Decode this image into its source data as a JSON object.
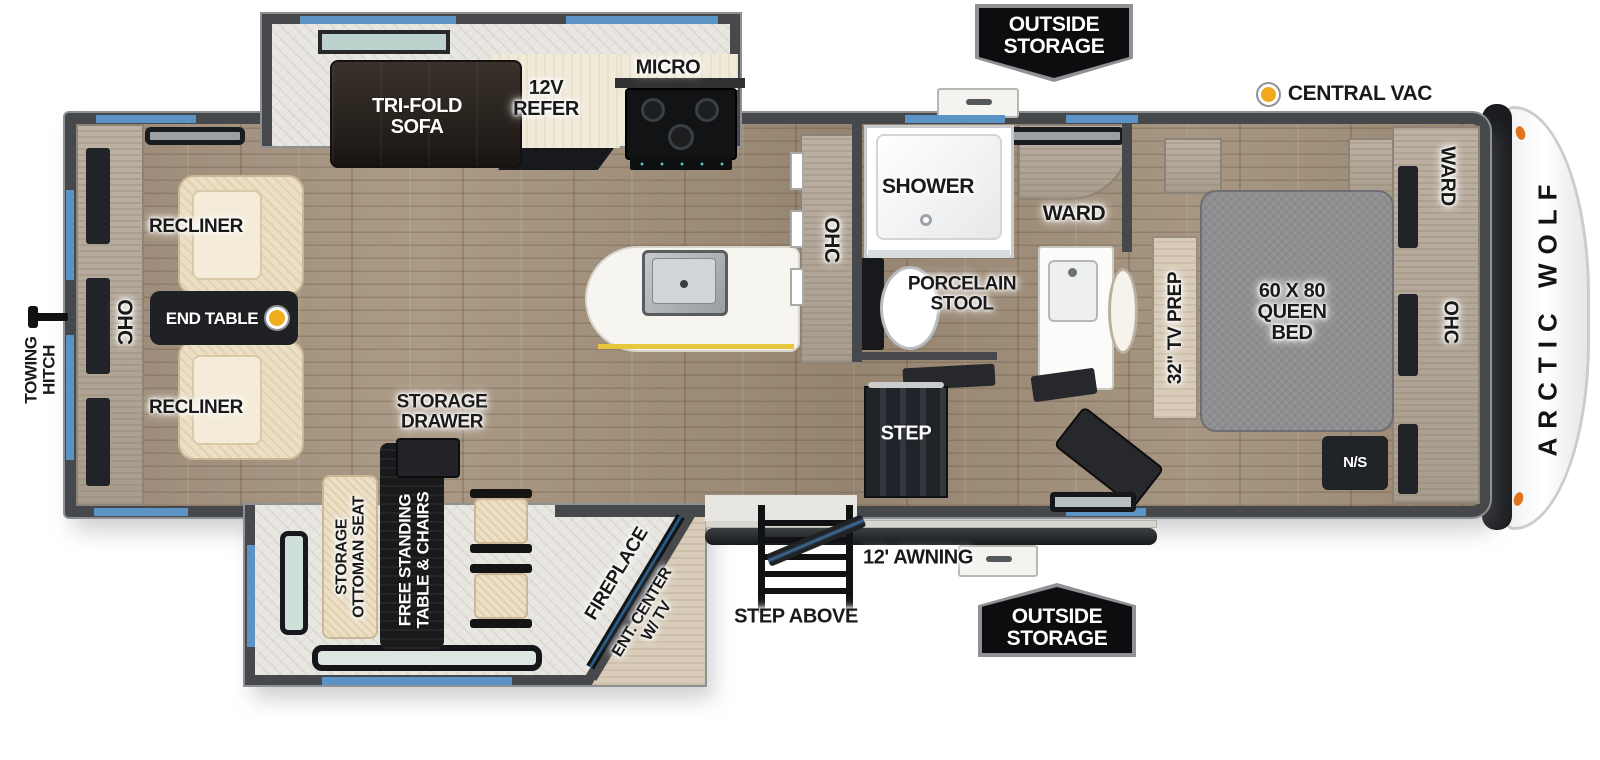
{
  "brand": "ARCTIC WOLF",
  "colors": {
    "accent_blue": "#5b93c4",
    "accent_yellow": "#f0ad1e",
    "accent_orange": "#e0731f",
    "wall": "#46484c",
    "badge_bg": "#0c0d0e"
  },
  "exterior": {
    "outside_storage_top": "OUTSIDE\nSTORAGE",
    "outside_storage_bottom": "OUTSIDE\nSTORAGE",
    "central_vac": "CENTRAL VAC",
    "awning": "12' AWNING",
    "step_above": "STEP ABOVE",
    "towing_hitch": "TOWING\nHITCH"
  },
  "living": {
    "ohc_rear": "OHC",
    "recliner_top": "RECLINER",
    "recliner_bottom": "RECLINER",
    "end_table": "END TABLE",
    "sofa": "TRI-FOLD\nSOFA"
  },
  "kitchen": {
    "refer": "12V\nREFER",
    "micro": "MICRO",
    "ohc_pantry": "OHC"
  },
  "dining": {
    "storage_drawer": "STORAGE\nDRAWER",
    "ottoman": "STORAGE\nOTTOMAN SEAT",
    "table": "FREE STANDING\nTABLE & CHAIRS",
    "fireplace": "FIREPLACE",
    "ent_center": "ENT. CENTER\nW/ TV"
  },
  "bath": {
    "shower": "SHOWER",
    "stool": "PORCELAIN\nSTOOL",
    "ward": "WARD"
  },
  "bedroom": {
    "step": "STEP",
    "tv_prep": "32\" TV PREP",
    "bed": "60 X 80\nQUEEN\nBED",
    "ns": "N/S",
    "ward": "WARD",
    "ohc": "OHC"
  }
}
